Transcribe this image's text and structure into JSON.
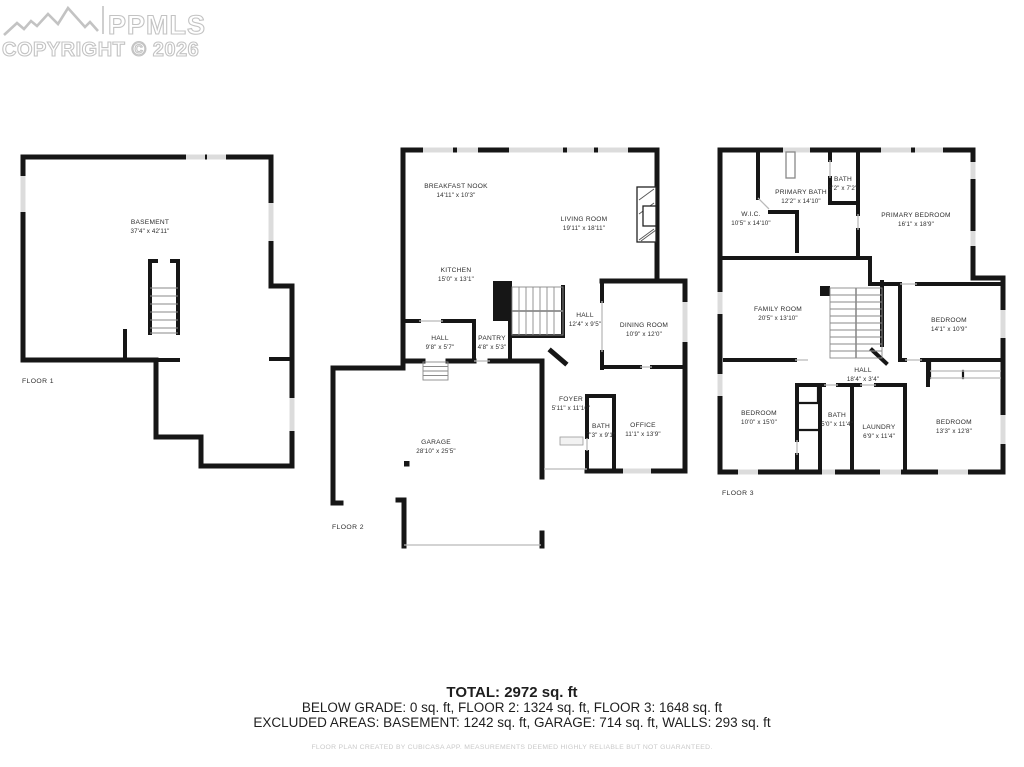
{
  "watermark": {
    "brand": "PPMLS",
    "copyright": "COPYRIGHT © 2026"
  },
  "colors": {
    "wall": "#161616",
    "window": "#dcdcdc",
    "stair": "#8a8a8a",
    "door_line": "#b9b9b9"
  },
  "floors": {
    "f1": {
      "label": "FLOOR 1",
      "rooms": {
        "basement": {
          "name": "BASEMENT",
          "dims": "37'4\" x 42'11\""
        }
      }
    },
    "f2": {
      "label": "FLOOR 2",
      "rooms": {
        "breakfast_nook": {
          "name": "BREAKFAST NOOK",
          "dims": "14'11\" x 10'3\""
        },
        "living_room": {
          "name": "LIVING ROOM",
          "dims": "19'11\" x 18'11\""
        },
        "kitchen": {
          "name": "KITCHEN",
          "dims": "15'0\" x 13'1\""
        },
        "hall_small": {
          "name": "HALL",
          "dims": "9'8\" x 5'7\""
        },
        "pantry": {
          "name": "PANTRY",
          "dims": "4'8\" x 5'3\""
        },
        "hall_main": {
          "name": "HALL",
          "dims": "12'4\" x 9'5\""
        },
        "dining_room": {
          "name": "DINING ROOM",
          "dims": "10'9\" x 12'0\""
        },
        "foyer": {
          "name": "FOYER",
          "dims": "5'11\" x 11'10\""
        },
        "bath": {
          "name": "BATH",
          "dims": "7'3\" x 9'1\""
        },
        "office": {
          "name": "OFFICE",
          "dims": "11'1\" x 13'9\""
        },
        "garage": {
          "name": "GARAGE",
          "dims": "28'10\" x 25'5\""
        }
      }
    },
    "f3": {
      "label": "FLOOR 3",
      "rooms": {
        "wic": {
          "name": "W.I.C.",
          "dims": "10'5\" x 14'10\""
        },
        "primary_bath": {
          "name": "PRIMARY BATH",
          "dims": "12'2\" x 14'10\""
        },
        "bath_small": {
          "name": "BATH",
          "dims": "3'2\" x 7'2\""
        },
        "primary_bedroom": {
          "name": "PRIMARY BEDROOM",
          "dims": "16'1\" x 18'9\""
        },
        "family_room": {
          "name": "FAMILY ROOM",
          "dims": "20'5\" x 13'10\""
        },
        "bedroom_mid": {
          "name": "BEDROOM",
          "dims": "14'1\" x 10'9\""
        },
        "hall": {
          "name": "HALL",
          "dims": "18'4\" x 3'4\""
        },
        "bedroom_left": {
          "name": "BEDROOM",
          "dims": "10'0\" x 15'0\""
        },
        "bath": {
          "name": "BATH",
          "dims": "5'0\" x 11'4\""
        },
        "laundry": {
          "name": "LAUNDRY",
          "dims": "6'9\" x 11'4\""
        },
        "bedroom_right": {
          "name": "BEDROOM",
          "dims": "13'3\" x 12'8\""
        }
      }
    }
  },
  "summary": {
    "total": "TOTAL: 2972 sq. ft",
    "floors_line": "BELOW GRADE: 0 sq. ft, FLOOR 2: 1324 sq. ft, FLOOR 3: 1648 sq. ft",
    "excluded_line": "EXCLUDED AREAS: BASEMENT: 1242 sq. ft, GARAGE: 714 sq. ft, WALLS: 293 sq. ft",
    "disclaimer": "FLOOR PLAN CREATED BY CUBICASA APP. MEASUREMENTS DEEMED HIGHLY RELIABLE BUT NOT GUARANTEED."
  }
}
